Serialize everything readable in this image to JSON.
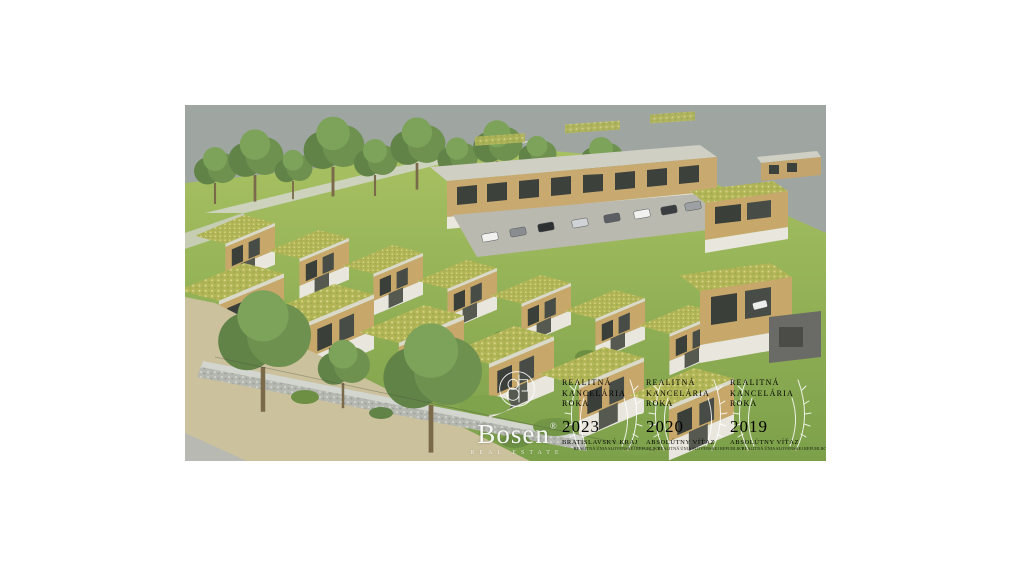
{
  "rendering": {
    "description": "Aerial 3D architectural rendering of a modern row-house development with green sedum roofs, parking court, hillside with trees, gabion stone wall and beige field in the foreground",
    "colors": {
      "page_background": "#ffffff",
      "sky": "#9fa6a2",
      "grass_light": "#a5c05f",
      "grass_dark": "#7ca04a",
      "wood_facade": "#c7a86a",
      "green_roof": "#b2b556",
      "field": "#cbc19d",
      "stone_wall": "#b5b8b0",
      "asphalt": "#b9b9b0"
    }
  },
  "watermark": {
    "logo": {
      "brand": "Bosen",
      "registered_mark": "®",
      "tagline": "REAL ESTATE"
    },
    "awards": [
      {
        "line1": "REALITNÁ",
        "line2": "KANCELÁRIA",
        "line3": "ROKA",
        "year": "2023",
        "subtitle": "BRATISLAVSKÝ KRAJ",
        "small_text": "REALITNÁ ÚNIA SLOVENSKEJ REPUBLIKY"
      },
      {
        "line1": "REALITNÁ",
        "line2": "KANCELÁRIA",
        "line3": "ROKA",
        "year": "2020",
        "subtitle": "ABSOLÚTNY VÍŤAZ",
        "small_text": "REALITNÁ ÚNIA SLOVENSKEJ REPUBLIKY"
      },
      {
        "line1": "REALITNÁ",
        "line2": "KANCELÁRIA",
        "line3": "ROKA",
        "year": "2019",
        "subtitle": "ABSOLÚTNY VÍŤAZ",
        "small_text": "REALITNÁ ÚNIA SLOVENSKEJ REPUBLIKY"
      }
    ]
  }
}
